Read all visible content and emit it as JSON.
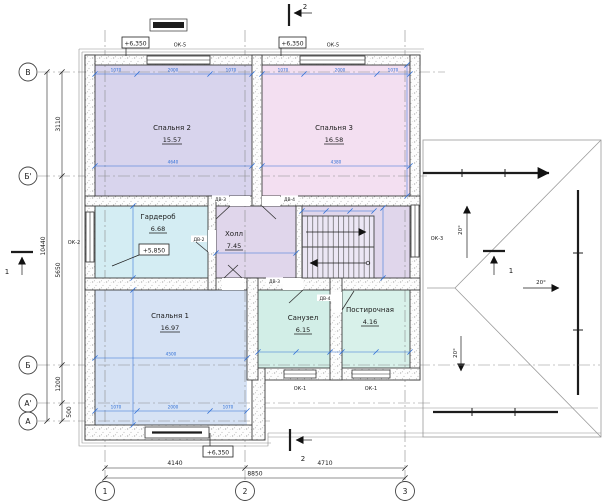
{
  "rooms": [
    {
      "name": "Спальня 2",
      "area": "15.57"
    },
    {
      "name": "Спальня 3",
      "area": "16.58"
    },
    {
      "name": "Гардероб",
      "area": "6.68"
    },
    {
      "name": "Холл",
      "area": "7.45"
    },
    {
      "name": "Спальня 1",
      "area": "16.97"
    },
    {
      "name": "Санузел",
      "area": "6.15"
    },
    {
      "name": "Постирочная",
      "area": "4.16"
    }
  ],
  "axes": {
    "rows": [
      "В",
      "Б'",
      "Б",
      "А'",
      "А"
    ],
    "cols": [
      "1",
      "2",
      "3"
    ]
  },
  "dims": {
    "left": [
      "3110",
      "5650",
      "1200",
      "500"
    ],
    "left_total": "10440",
    "bottom": [
      "4140",
      "4710"
    ],
    "bottom_total": "8850",
    "interior": {
      "side": "1070",
      "mid": "2000",
      "sp2_w": "4640",
      "sp3_w": "4380",
      "sp1_w": "4500"
    }
  },
  "levels": {
    "roof": "+6,350",
    "floor": "+5,850"
  },
  "windows": {
    "ok1": "ОК-1",
    "ok2": "ОК-2",
    "ok3": "ОК-3",
    "ok5": "ОК-5"
  },
  "doors": {
    "dv2": "ДВ-2",
    "dv3": "ДВ-3",
    "dv4": "ДВ-4"
  },
  "roof": {
    "slope": "20°"
  },
  "sections": {
    "s1": "1",
    "s2": "2"
  },
  "colors": {
    "dim_blue": "#2f6fd6",
    "room_sp2": "#d8d4ed",
    "room_sp3": "#f3dff1",
    "room_gard": "#d4edf3",
    "room_hall": "#e0d6eb",
    "room_sp1": "#d6e2f4",
    "room_san": "#d2eee7",
    "room_post": "#d8f1ea"
  }
}
